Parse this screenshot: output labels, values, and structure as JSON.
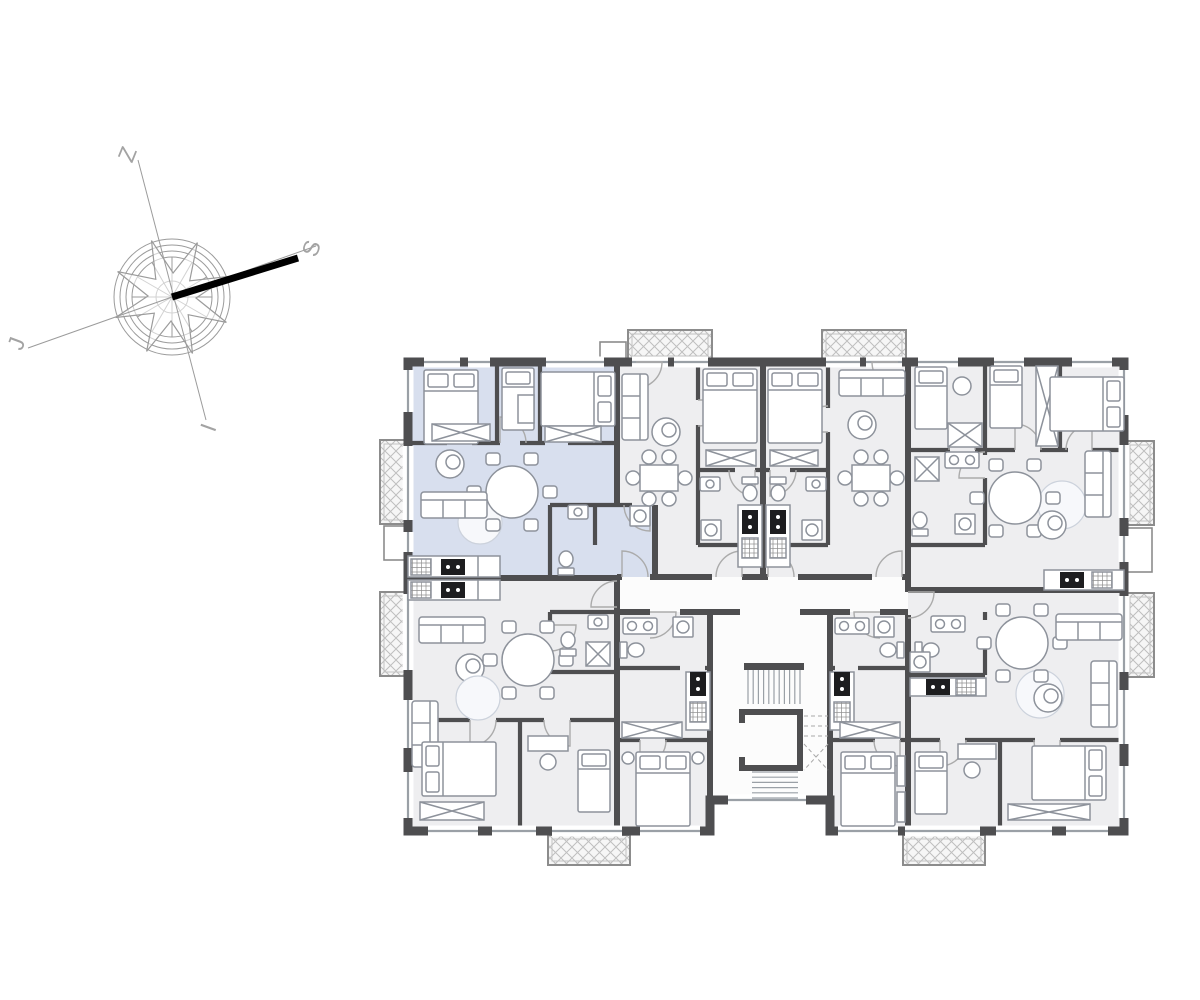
{
  "meta": {
    "title": "Residential building floor plan with one highlighted apartment",
    "drawing_type": "architectural floor plan"
  },
  "compass": {
    "labels": {
      "north": "S",
      "south": "J",
      "east": "I",
      "west": "Z"
    }
  },
  "colors": {
    "page_bg": "#ffffff",
    "wall": "#4e4e50",
    "floor": "#eeeef0",
    "floor_highlight": "#d8dfee",
    "corridor": "#fcfcfc",
    "furniture_stroke": "#8d929b",
    "furniture_fill": "#ffffff",
    "rug_fill": "#f7f8fb",
    "rug_stroke": "#ccd2dc",
    "appliance_dark": "#1d1d1f",
    "balcony_fill": "#f6f6f6",
    "balcony_hatch": "#bfbfbf",
    "balcony_border": "#8c8c8c",
    "window_line": "#9aa0a6",
    "door_arc": "#ababab",
    "stair_line": "#9aa0a6",
    "compass_line": "#9b9b9b",
    "compass_text": "#a3a3a3",
    "north_bar": "#000000"
  },
  "building": {
    "units": [
      {
        "id": "unit-top-left",
        "highlighted": true
      },
      {
        "id": "unit-top-mid-left",
        "highlighted": false
      },
      {
        "id": "unit-top-mid-right",
        "highlighted": false
      },
      {
        "id": "unit-top-right",
        "highlighted": false
      },
      {
        "id": "unit-bottom-left",
        "highlighted": false
      },
      {
        "id": "unit-bottom-mid-left",
        "highlighted": false
      },
      {
        "id": "unit-bottom-mid-right",
        "highlighted": false
      },
      {
        "id": "unit-bottom-right",
        "highlighted": false
      }
    ],
    "core": {
      "id": "stairwell"
    },
    "balcony_count": 8
  }
}
